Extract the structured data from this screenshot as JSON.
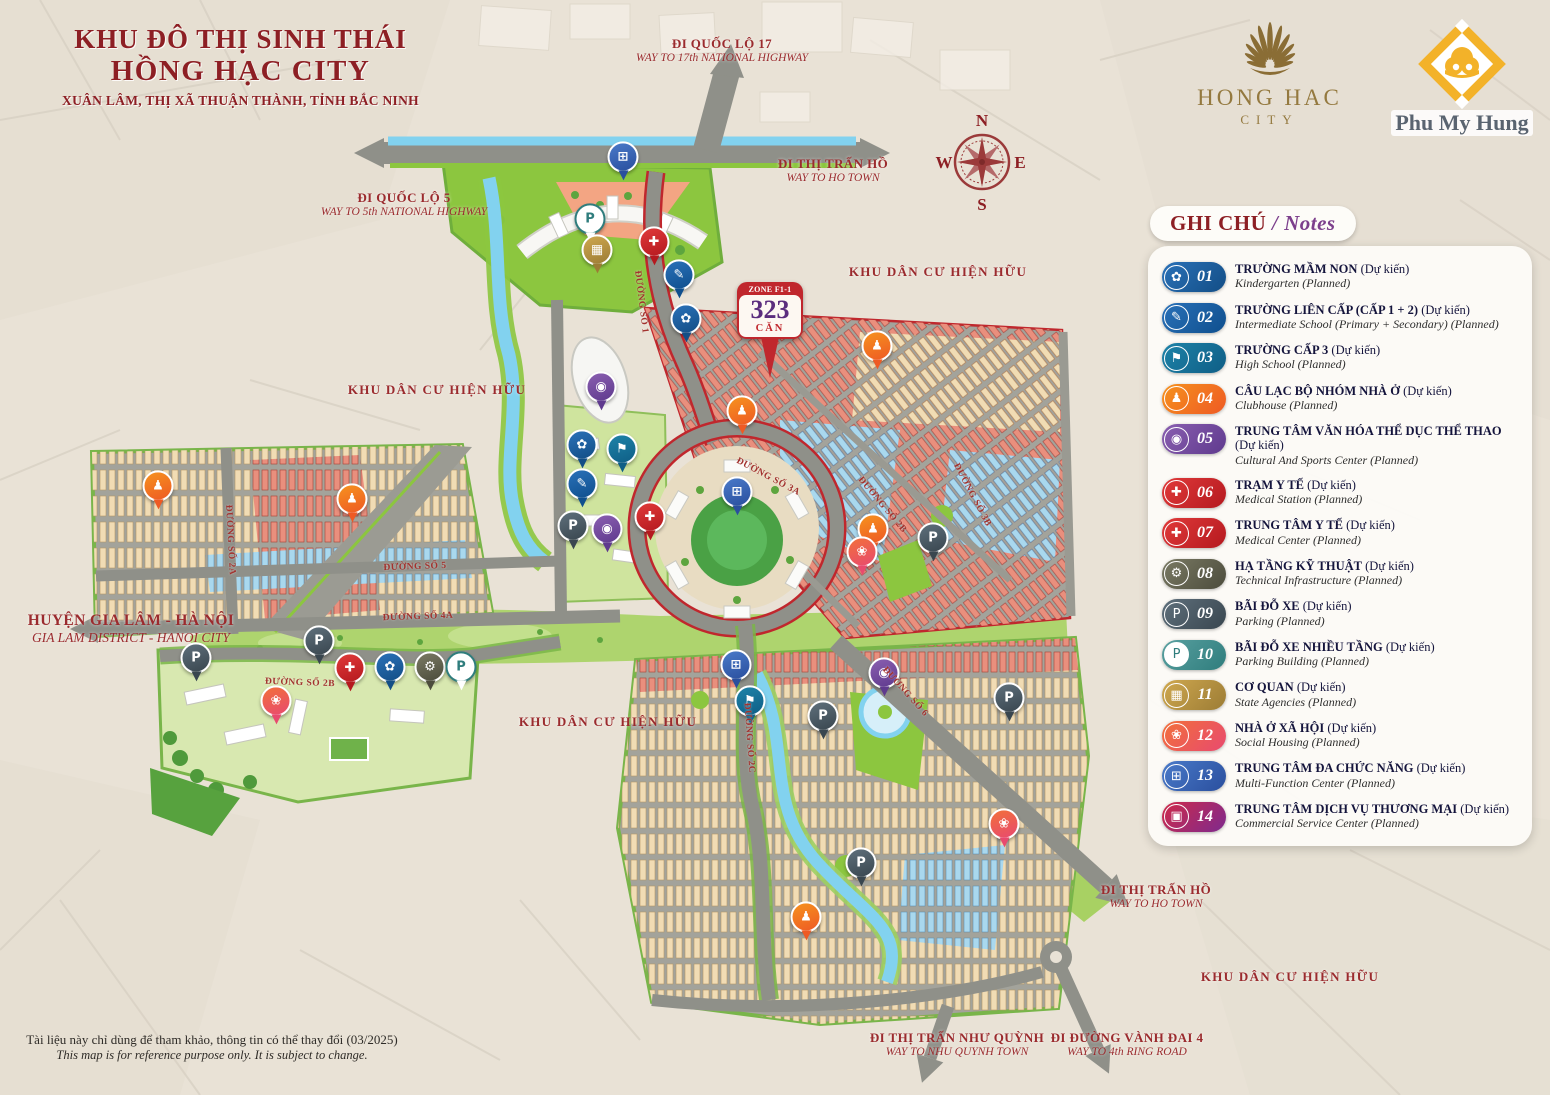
{
  "title": {
    "line1": "KHU ĐÔ THỊ SINH THÁI",
    "line2": "HỒNG HẠC CITY",
    "line3": "XUÂN LÂM, THỊ XÃ THUẬN THÀNH, TỈNH BẮC NINH"
  },
  "logos": {
    "hong_hac": {
      "name": "HONG HAC",
      "sub": "CITY"
    },
    "phu_my_hung": {
      "name": "Phu My Hung"
    }
  },
  "compass": {
    "n": "N",
    "e": "E",
    "s": "S",
    "w": "W"
  },
  "zone_badge": {
    "zone": "ZONE F1-1",
    "number": "323",
    "unit": "CĂN"
  },
  "legend": {
    "header_vi": "GHI CHÚ",
    "header_en": " / Notes",
    "items": [
      {
        "num": "01",
        "title_vi": "TRƯỜNG MẦM NON",
        "planned": "(Dự kiến)",
        "title_en": "Kindergarten (Planned)",
        "color1": "#2a71b8",
        "color2": "#134e86",
        "glyph": "✿",
        "icon": "kindergarten-icon",
        "outline": false
      },
      {
        "num": "02",
        "title_vi": "TRƯỜNG LIÊN CẤP (CẤP 1 + 2)",
        "planned": "(Dự kiến)",
        "title_en": "Intermediate School (Primary + Secondary) (Planned)",
        "color1": "#2a71b8",
        "color2": "#0f4f8e",
        "glyph": "✎",
        "icon": "school-bag-icon",
        "outline": false
      },
      {
        "num": "03",
        "title_vi": "TRƯỜNG CẤP 3",
        "planned": "(Dự kiến)",
        "title_en": "High School (Planned)",
        "color1": "#1e83a8",
        "color2": "#0f5e86",
        "glyph": "⚑",
        "icon": "graduation-cap-icon",
        "outline": false
      },
      {
        "num": "04",
        "title_vi": "CÂU LẠC BỘ NHÓM NHÀ Ở",
        "planned": "(Dự kiến)",
        "title_en": "Clubhouse (Planned)",
        "color1": "#f6921e",
        "color2": "#ee5a24",
        "glyph": "♟",
        "icon": "people-icon",
        "outline": false
      },
      {
        "num": "05",
        "title_vi": "TRUNG TÂM VĂN HÓA THỂ DỤC THỂ THAO",
        "planned": "(Dự kiến)",
        "title_en": "Cultural And Sports Center (Planned)",
        "color1": "#8a5fb0",
        "color2": "#5f3a8e",
        "glyph": "◉",
        "icon": "sports-icon",
        "outline": false
      },
      {
        "num": "06",
        "title_vi": "TRẠM Y TẾ",
        "planned": "(Dự kiến)",
        "title_en": "Medical Station (Planned)",
        "color1": "#e03a3a",
        "color2": "#b5191f",
        "glyph": "✚",
        "icon": "first-aid-kit-icon",
        "outline": false
      },
      {
        "num": "07",
        "title_vi": "TRUNG TÂM Y TẾ",
        "planned": "(Dự kiến)",
        "title_en": "Medical Center (Planned)",
        "color1": "#e03a3a",
        "color2": "#b5191f",
        "glyph": "✚",
        "icon": "medical-cross-icon",
        "outline": false
      },
      {
        "num": "08",
        "title_vi": "HẠ TẦNG KỸ THUẬT",
        "planned": "(Dự kiến)",
        "title_en": "Technical Infrastructure (Planned)",
        "color1": "#7a7a64",
        "color2": "#4c4c3c",
        "glyph": "⚙",
        "icon": "gear-icon",
        "outline": false
      },
      {
        "num": "09",
        "title_vi": "BÃI ĐỖ XE",
        "planned": "(Dự kiến)",
        "title_en": "Parking (Planned)",
        "color1": "#5f707c",
        "color2": "#39464f",
        "glyph": "P",
        "icon": "parking-icon",
        "outline": false
      },
      {
        "num": "10",
        "title_vi": "BÃI ĐỖ XE NHIỀU TẦNG",
        "planned": "(Dự kiến)",
        "title_en": "Parking Building (Planned)",
        "color1": "#59a0a0",
        "color2": "#2f7d7d",
        "glyph": "P",
        "icon": "parking-building-icon",
        "outline": true
      },
      {
        "num": "11",
        "title_vi": "CƠ QUAN",
        "planned": "(Dự kiến)",
        "title_en": "State Agencies (Planned)",
        "color1": "#cfa84f",
        "color2": "#9c7c35",
        "glyph": "▦",
        "icon": "government-building-icon",
        "outline": false
      },
      {
        "num": "12",
        "title_vi": "NHÀ Ở XÃ HỘI",
        "planned": "(Dự kiến)",
        "title_en": "Social Housing (Planned)",
        "color1": "#f2703a",
        "color2": "#e84a6f",
        "glyph": "❀",
        "icon": "lotus-icon",
        "outline": false
      },
      {
        "num": "13",
        "title_vi": "TRUNG TÂM ĐA CHỨC NĂNG",
        "planned": "(Dự kiến)",
        "title_en": "Multi-Function Center (Planned)",
        "color1": "#4a7ac9",
        "color2": "#2a4f9e",
        "glyph": "⊞",
        "icon": "multi-function-icon",
        "outline": false
      },
      {
        "num": "14",
        "title_vi": "TRUNG TÂM DỊCH VỤ THƯƠNG MẠI",
        "planned": "(Dự kiến)",
        "title_en": "Commercial Service Center (Planned)",
        "color1": "#cf2a49",
        "color2": "#7e2a8e",
        "glyph": "▣",
        "icon": "shopping-cart-icon",
        "outline": false
      }
    ]
  },
  "map": {
    "direction_labels": [
      {
        "id": "ql17",
        "vi": "ĐI QUỐC LỘ 17",
        "en": "WAY TO 17th NATIONAL HIGHWAY",
        "x": 722,
        "y": 36,
        "big": false
      },
      {
        "id": "ho-town-top",
        "vi": "ĐI THỊ TRẤN HỒ",
        "en": "WAY TO HO TOWN",
        "x": 833,
        "y": 156,
        "big": false
      },
      {
        "id": "ql5",
        "vi": "ĐI QUỐC LỘ 5",
        "en": "WAY TO 5th NATIONAL HIGHWAY",
        "x": 404,
        "y": 190,
        "big": false
      },
      {
        "id": "gia-lam",
        "vi": "HUYỆN GIA LÂM - HÀ NỘI",
        "en": "GIA LAM DISTRICT - HANOI CITY",
        "x": 131,
        "y": 612,
        "big": true
      },
      {
        "id": "ho-town-right",
        "vi": "ĐI THỊ TRẤN HỒ",
        "en": "WAY TO HO TOWN",
        "x": 1156,
        "y": 882,
        "big": false
      },
      {
        "id": "nhu-quynh",
        "vi": "ĐI THỊ TRẤN NHƯ QUỲNH",
        "en": "WAY TO NHU QUYNH TOWN",
        "x": 957,
        "y": 1030,
        "big": false
      },
      {
        "id": "vanh-dai-4",
        "vi": "ĐI ĐƯỜNG VÀNH ĐAI 4",
        "en": "WAY TO 4th RING ROAD",
        "x": 1127,
        "y": 1030,
        "big": false
      }
    ],
    "area_labels": [
      {
        "text": "KHU DÂN CƯ HIỆN HỮU",
        "x": 938,
        "y": 272
      },
      {
        "text": "KHU DÂN CƯ HIỆN HỮU",
        "x": 437,
        "y": 390
      },
      {
        "text": "KHU DÂN CƯ HIỆN HỮU",
        "x": 608,
        "y": 722
      },
      {
        "text": "KHU DÂN CƯ HIỆN HỮU",
        "x": 1290,
        "y": 977
      }
    ],
    "road_labels": [
      {
        "text": "ĐƯỜNG SỐ 1",
        "x": 641,
        "y": 302,
        "rot": 83
      },
      {
        "text": "ĐƯỜNG SỐ 3A",
        "x": 768,
        "y": 477,
        "rot": 28
      },
      {
        "text": "ĐƯỜNG SỐ 2B",
        "x": 882,
        "y": 505,
        "rot": 50
      },
      {
        "text": "ĐƯỜNG SỐ 3B",
        "x": 972,
        "y": 495,
        "rot": 62
      },
      {
        "text": "ĐƯỜNG SỐ 5",
        "x": 415,
        "y": 567,
        "rot": -2
      },
      {
        "text": "ĐƯỜNG SỐ 4A",
        "x": 418,
        "y": 617,
        "rot": -2
      },
      {
        "text": "ĐƯỜNG SỐ 2A",
        "x": 230,
        "y": 540,
        "rot": 87
      },
      {
        "text": "ĐƯỜNG SỐ 2B",
        "x": 300,
        "y": 683,
        "rot": 2
      },
      {
        "text": "ĐƯỜNG SỐ 2C",
        "x": 749,
        "y": 738,
        "rot": 86
      },
      {
        "text": "ĐƯỜNG SỐ 6",
        "x": 905,
        "y": 692,
        "rot": 48
      }
    ],
    "pins": [
      {
        "x": 623,
        "y": 178,
        "type": "13"
      },
      {
        "x": 590,
        "y": 240,
        "type": "10"
      },
      {
        "x": 597,
        "y": 271,
        "type": "11"
      },
      {
        "x": 654,
        "y": 263,
        "type": "06"
      },
      {
        "x": 679,
        "y": 296,
        "type": "02"
      },
      {
        "x": 686,
        "y": 340,
        "type": "01"
      },
      {
        "x": 742,
        "y": 432,
        "type": "04"
      },
      {
        "x": 877,
        "y": 367,
        "type": "04"
      },
      {
        "x": 601,
        "y": 408,
        "type": "05"
      },
      {
        "x": 582,
        "y": 466,
        "type": "01"
      },
      {
        "x": 622,
        "y": 470,
        "type": "03"
      },
      {
        "x": 582,
        "y": 505,
        "type": "02"
      },
      {
        "x": 607,
        "y": 550,
        "type": "05"
      },
      {
        "x": 650,
        "y": 538,
        "type": "07"
      },
      {
        "x": 737,
        "y": 513,
        "type": "13"
      },
      {
        "x": 573,
        "y": 547,
        "type": "09"
      },
      {
        "x": 873,
        "y": 550,
        "type": "04"
      },
      {
        "x": 933,
        "y": 559,
        "type": "09"
      },
      {
        "x": 862,
        "y": 573,
        "type": "12"
      },
      {
        "x": 158,
        "y": 507,
        "type": "04"
      },
      {
        "x": 352,
        "y": 520,
        "type": "04"
      },
      {
        "x": 319,
        "y": 662,
        "type": "09"
      },
      {
        "x": 196,
        "y": 679,
        "type": "09"
      },
      {
        "x": 350,
        "y": 689,
        "type": "06"
      },
      {
        "x": 390,
        "y": 688,
        "type": "01"
      },
      {
        "x": 430,
        "y": 688,
        "type": "08"
      },
      {
        "x": 461,
        "y": 688,
        "type": "10"
      },
      {
        "x": 276,
        "y": 722,
        "type": "12"
      },
      {
        "x": 736,
        "y": 686,
        "type": "13"
      },
      {
        "x": 750,
        "y": 722,
        "type": "03"
      },
      {
        "x": 884,
        "y": 694,
        "type": "05"
      },
      {
        "x": 823,
        "y": 737,
        "type": "09"
      },
      {
        "x": 1009,
        "y": 719,
        "type": "09"
      },
      {
        "x": 861,
        "y": 884,
        "type": "09"
      },
      {
        "x": 1004,
        "y": 845,
        "type": "12"
      },
      {
        "x": 806,
        "y": 938,
        "type": "04"
      }
    ]
  },
  "disclaimer": {
    "vi": "Tài liệu này chỉ dùng để tham khảo, thông tin có thể thay đổi (03/2025)",
    "en": "This map is for reference purpose only. It is subject to change."
  },
  "colors": {
    "accent_red": "#8d1f24",
    "label_red": "#9b2b2e",
    "water": "#82d2ef",
    "park_green": "#8cc63f",
    "road_gray": "#8f9089",
    "legend_purple": "#7c3f8c",
    "zone_red": "#c0272d",
    "housing_salmon": "#e98f7d",
    "housing_cream": "#f1dcb4",
    "housing_blue": "#a9d8ee",
    "gold": "#f3b229"
  }
}
